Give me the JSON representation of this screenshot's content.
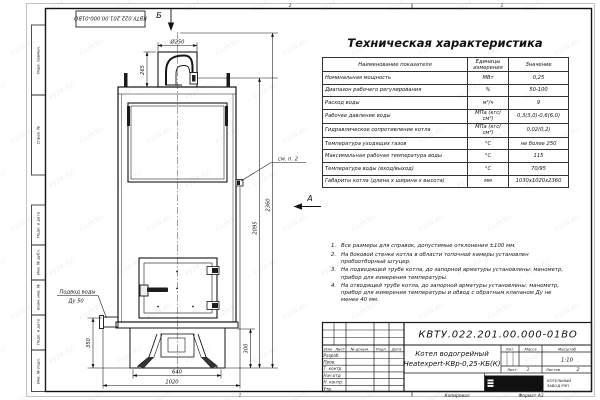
{
  "sheet": {
    "watermark": "KVZR.RU",
    "zone_top_left": "2",
    "zone_top_right": "1",
    "zone_bottom": "1",
    "footer_copy": "Копировал",
    "footer_format": "Формат А3"
  },
  "stamp_column": {
    "doc_number_top": "КВТУ.022.201.00.000-01ВО",
    "cells": [
      {
        "label": "Перв. примен."
      },
      {
        "label": "Справ. №"
      },
      {
        "label": "Подп. и дата"
      },
      {
        "label": "Инв. № дубл."
      },
      {
        "label": "Взам. инв. №"
      },
      {
        "label": "Подп. и дата"
      },
      {
        "label": "Инв. № подл."
      }
    ]
  },
  "drawing": {
    "view_arrow_top": "Б",
    "view_arrow_side": "А",
    "callout_note2": "см. п. 2",
    "water_inlet_label": "Подвод воды",
    "water_inlet_dn": "Ду 50",
    "dims": {
      "flue_diameter": "Ø250",
      "flue_height": "265",
      "total_height": "2360",
      "outlet_height": "2095",
      "base_height_left": "350",
      "base_height_right": "300",
      "base_width": "640",
      "overall_depth": "1020"
    }
  },
  "spec_table": {
    "title": "Техническая характеристика",
    "headers": [
      "Наименование показателя",
      "Единицы измерения",
      "Значение"
    ],
    "rows": [
      [
        "Номинальная мощность",
        "МВт",
        "0,25"
      ],
      [
        "Диапазон рабочего регулирования",
        "%",
        "50-100"
      ],
      [
        "Расход воды",
        "м³/ч",
        "9"
      ],
      [
        "Рабочее давление воды",
        "МПа (кгс/см²)",
        "0,3(3,0)-0,6(6,0)"
      ],
      [
        "Гидравлическое сопротивление котла",
        "МПа (кгс/см²)",
        "0,02(0,2)"
      ],
      [
        "Температура уходящих газов",
        "°С",
        "не более 250"
      ],
      [
        "Максимальная рабочая температура воды",
        "°С",
        "115"
      ],
      [
        "Температура воды (вход/выход)",
        "°С",
        "70/95"
      ],
      [
        "Габариты котла (длина х ширина х высота)",
        "мм",
        "1030х1020х2360"
      ]
    ]
  },
  "notes": {
    "items": [
      {
        "num": "1.",
        "text": "Все размеры для справок, допустимые отклонения ±100 мм."
      },
      {
        "num": "2.",
        "text": "На боковой стенке котла в области топочной камеры установлен пробоотборный штуцер."
      },
      {
        "num": "3.",
        "text": "На подводящей трубе котла, до запорной арматуры установлены: манометр, прибор для измерения температуры."
      },
      {
        "num": "4.",
        "text": "На отводящей трубе котла, до запорной арматуры установлены: манометр, прибор для измерения температуры и обвод с обратным клапаном Ду не менее 40 мм."
      }
    ]
  },
  "title_block": {
    "doc_number": "КВТУ.022.201.00.000-01ВО",
    "product_line1": "Котел водогрейный",
    "product_line2": "Heatexpert-КВр-0,25-КБ(К)",
    "sign_cols": [
      "Изм",
      "Лист",
      "№ докум.",
      "Подп.",
      "Дата"
    ],
    "sign_rows": [
      "Разраб.",
      "Пров.",
      "Т. контр.",
      "Нач.отд",
      "Н. контр.",
      "Утв."
    ],
    "lit_label": "Лит.",
    "mass_label": "Масса",
    "scale_label": "Масштаб",
    "scale_value": "1:10",
    "sheet_label": "Лист",
    "sheet_value": "1",
    "sheets_label": "Листов",
    "sheets_value": "2",
    "logo_text": "KVZR",
    "logo_caption_line1": "КОТЕЛЬНЫЙ",
    "logo_caption_line2": "ЗАВОД РЭП"
  }
}
